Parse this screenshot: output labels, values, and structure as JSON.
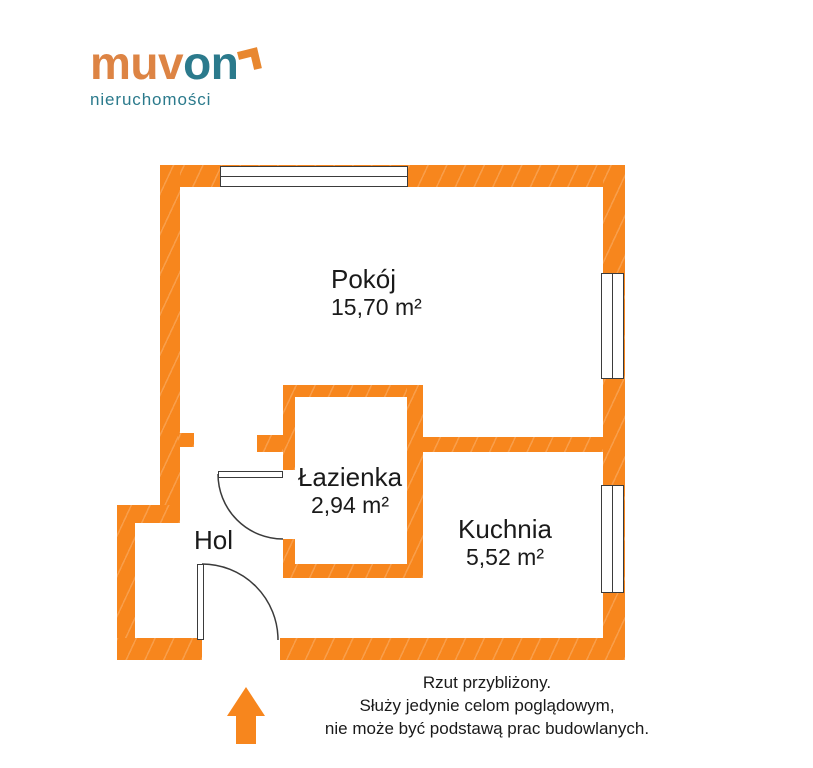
{
  "logo": {
    "brand_part1": "muv",
    "brand_part2": "on",
    "subtitle": "nieruchomości"
  },
  "rooms": {
    "pokoj": {
      "name": "Pokój",
      "area": "15,70 m²"
    },
    "lazienka": {
      "name": "Łazienka",
      "area": "2,94 m²"
    },
    "kuchnia": {
      "name": "Kuchnia",
      "area": "5,52 m²"
    },
    "hol": {
      "name": "Hol"
    }
  },
  "disclaimer": {
    "line1": "Rzut przybliżony.",
    "line2": "Służy jedynie celom poglądowym,",
    "line3": "nie może być podstawą prac budowlanych."
  },
  "colors": {
    "wall_orange": "#F7861D",
    "logo_orange": "#DD8444",
    "logo_teal": "#2B7A8C",
    "line_dark": "#3B3B3B",
    "label_text": "#1A1A1A"
  }
}
